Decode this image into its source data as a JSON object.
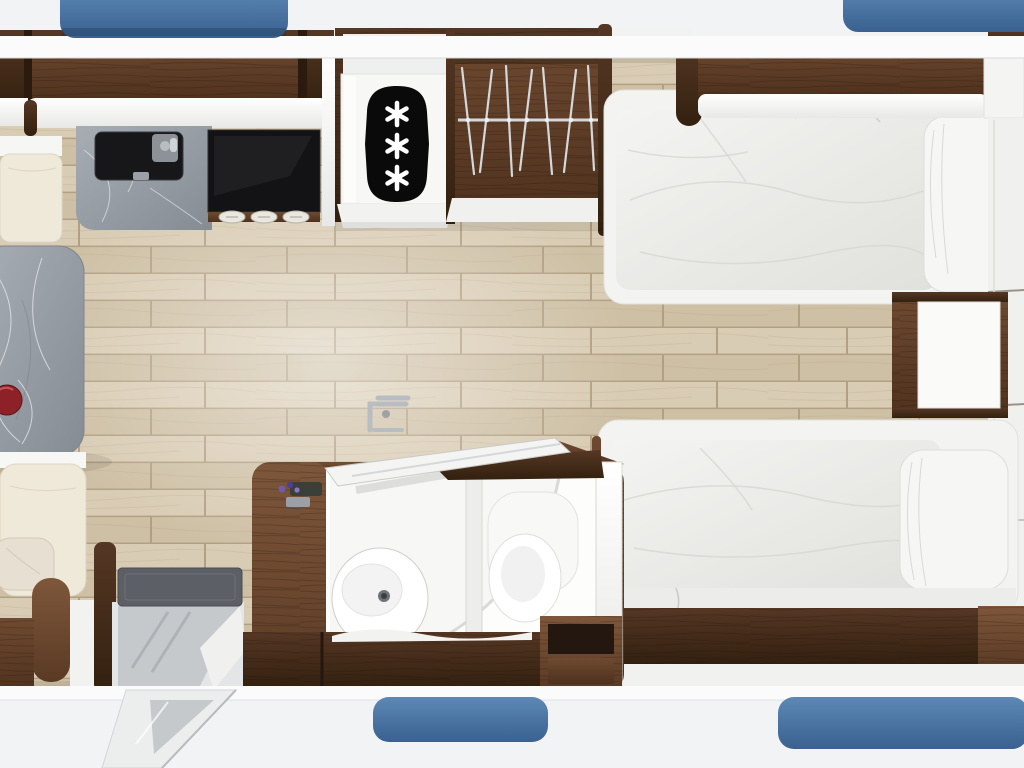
{
  "meta": {
    "description": "Top-down 3D rendered floor plan of a caravan interior",
    "view": "top-down floorplan render"
  },
  "colors": {
    "exterior": "#f2f3f5",
    "wall_white": "#fbfbfc",
    "window_blue_top": "#5d88b5",
    "window_blue_bottom": "#3a6190",
    "floor_plank_a": "#d9ccb4",
    "floor_plank_b": "#cec0a5",
    "floor_gap": "#b2a084",
    "wood_dark_hi": "#553724",
    "wood_dark_lo": "#33200f",
    "wood_mid_hi": "#6f4a31",
    "wood_mid_lo": "#4e311d",
    "wood_light_hi": "#7e573b",
    "wood_light_lo": "#5a3a24",
    "marble_hi": "#a7adb3",
    "marble_lo": "#858c94",
    "marble_vein": "#eef1f4",
    "appliance_black": "#131316",
    "badge_black": "#0a0a0b",
    "star_white": "#ffffff",
    "panel_white_hi": "#ffffff",
    "panel_white_lo": "#e8e8e6",
    "duvet_hi": "#f4f4f2",
    "duvet_lo": "#e0e0dc",
    "fold_grey": "#d6d6d2",
    "cushion_cream": "#efe9da",
    "pillow_white": "#f6f6f4",
    "mat_grey": "#5d5f66",
    "metal_step": "#c6c9cc",
    "chrome": "#b9bdc1",
    "rail_chrome": "#d5d8da",
    "bowl_red": "#8e2127",
    "toiletry_purple": "#6f5ab0"
  },
  "fixtures": {
    "freezer": {
      "star_count": 3,
      "star_symbol": "✱"
    },
    "wardrobe": {
      "hanger_count": 7
    },
    "cooktop": {
      "knob_count": 3,
      "burner_count": 2
    },
    "beds": {
      "count": 2
    },
    "windows": {
      "count": 4
    },
    "dinette": {
      "bench_count": 2
    },
    "bathroom": {
      "fixtures": [
        "sink",
        "shower",
        "toilet"
      ]
    }
  }
}
